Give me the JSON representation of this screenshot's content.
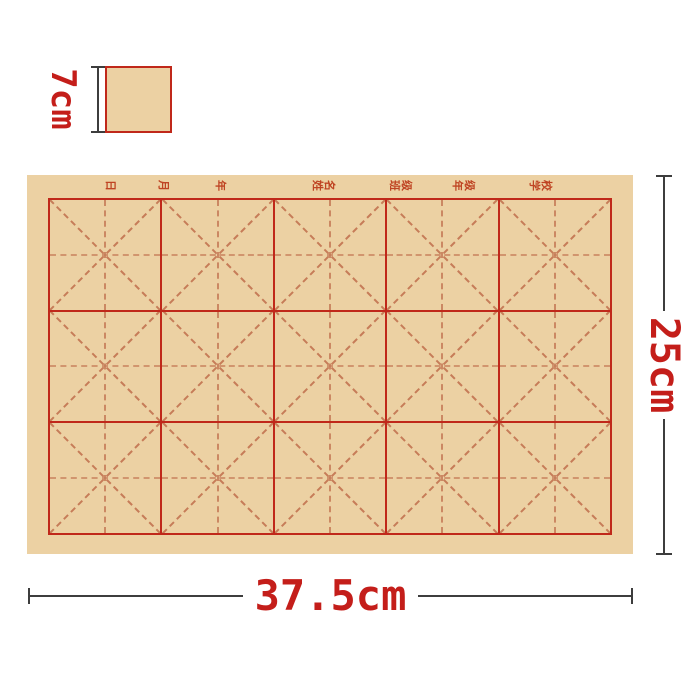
{
  "colors": {
    "page_bg": "#ffffff",
    "paper_fill": "#ecd1a3",
    "grid_line": "#c0281a",
    "grid_dash": "#c67c58",
    "legend_dash": "#d2904f",
    "dim_text": "#c41e1a",
    "dim_line": "#3d3d3d",
    "header_text": "#bf4423"
  },
  "legend": {
    "cell_size_label": "7cm"
  },
  "paper": {
    "grid": {
      "rows": 3,
      "cols": 5
    },
    "header_labels": [
      {
        "text": "日",
        "x": 83
      },
      {
        "text": "月",
        "x": 136
      },
      {
        "text": "年",
        "x": 193
      },
      {
        "text": "姓名",
        "x": 296
      },
      {
        "text": "班级",
        "x": 373
      },
      {
        "text": "年级",
        "x": 436
      },
      {
        "text": "学校",
        "x": 513
      }
    ]
  },
  "dimensions": {
    "width_label": "37.5cm",
    "height_label": "25cm"
  }
}
